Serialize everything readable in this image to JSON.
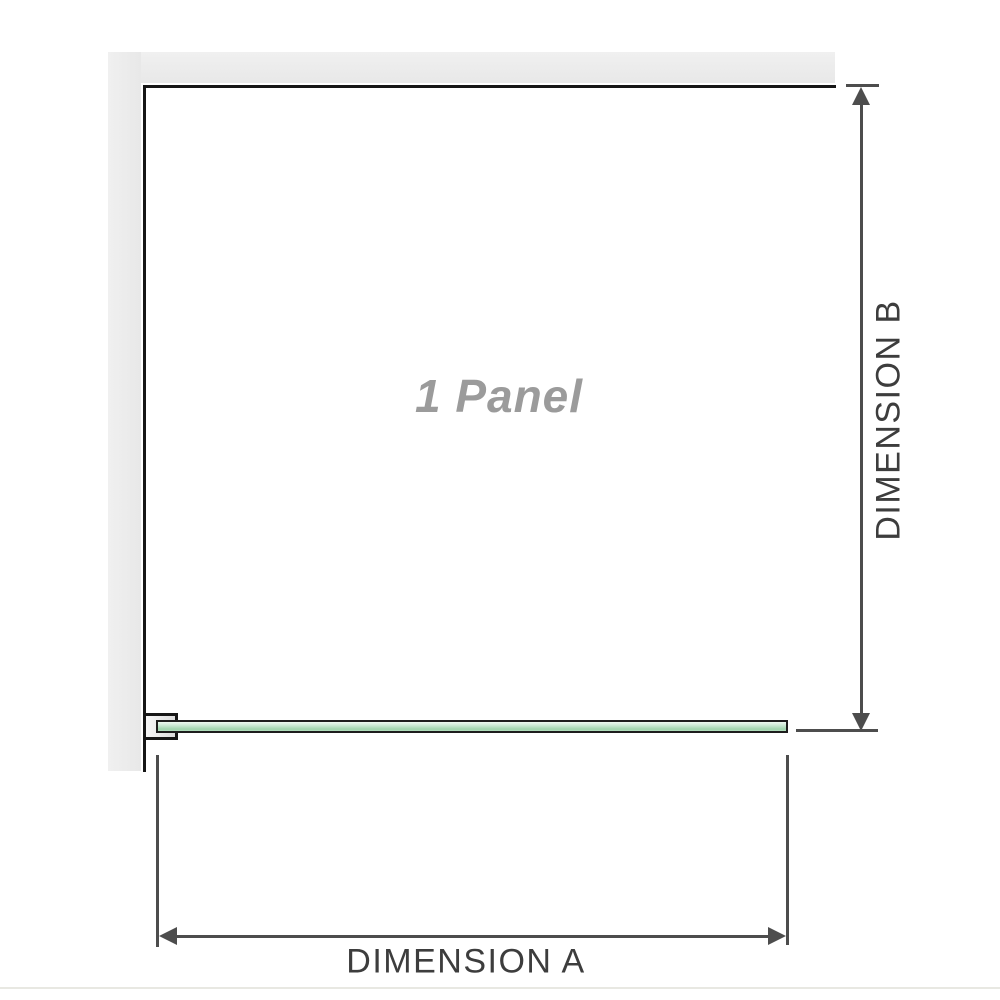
{
  "diagram": {
    "panel_label": "1 Panel",
    "dimension_a_label": "DIMENSION A",
    "dimension_b_label": "DIMENSION B"
  },
  "colors": {
    "background": "#ffffff",
    "wall_fill": "#e9e9e9",
    "wall_edge": "#161616",
    "glass_fill_light": "#eef8f1",
    "glass_fill_dark": "#9fd3ac",
    "glass_border": "#1d1d1d",
    "dimension_line": "#4d4d4d",
    "dimension_text": "#3d3d3d",
    "panel_text": "#9b9b9b"
  }
}
